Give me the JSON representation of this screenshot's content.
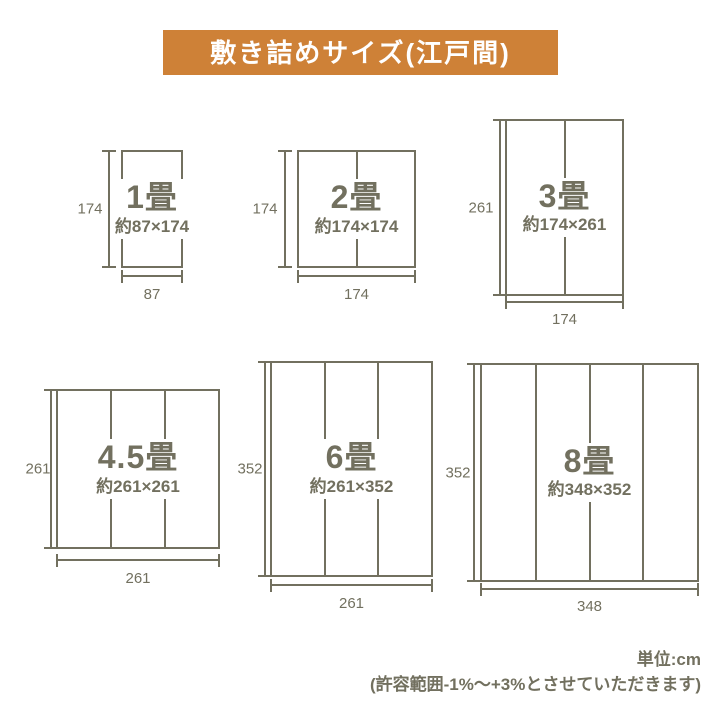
{
  "title": "敷き詰めサイズ(江戸間)",
  "colors": {
    "banner_bg": "#CE8137",
    "title_text": "#FFFFFF",
    "line": "#72705F",
    "page_bg": "#FFFFFF"
  },
  "diagrams": [
    {
      "id": "1jo",
      "label": "1畳",
      "size": "約87×174",
      "width_label": "87",
      "height_label": "174",
      "tatami_columns": 1
    },
    {
      "id": "2jo",
      "label": "2畳",
      "size": "約174×174",
      "width_label": "174",
      "height_label": "174",
      "tatami_columns": 2
    },
    {
      "id": "3jo",
      "label": "3畳",
      "size": "約174×261",
      "width_label": "174",
      "height_label": "261",
      "tatami_columns": 2
    },
    {
      "id": "45jo",
      "label": "4.5畳",
      "size": "約261×261",
      "width_label": "261",
      "height_label": "261",
      "tatami_columns": 3
    },
    {
      "id": "6jo",
      "label": "6畳",
      "size": "約261×352",
      "width_label": "261",
      "height_label": "352",
      "tatami_columns": 3
    },
    {
      "id": "8jo",
      "label": "8畳",
      "size": "約348×352",
      "width_label": "348",
      "height_label": "352",
      "tatami_columns": 4
    }
  ],
  "footer": {
    "unit": "単位:cm",
    "tolerance": "(許容範囲-1%〜+3%とさせていただきます)"
  }
}
